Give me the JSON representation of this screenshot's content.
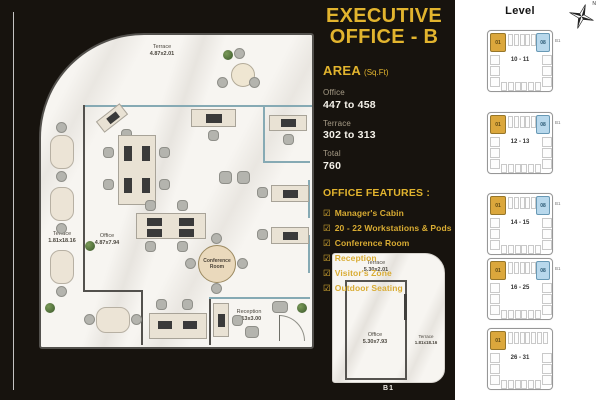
{
  "colors": {
    "gold": "#E2B42E",
    "background": "#17130E",
    "unit_gold": "#DBA73C",
    "unit_blue": "#B8D8EC"
  },
  "panel": {
    "title_line1": "EXECUTIVE",
    "title_line2": "OFFICE - B",
    "area_label": "AREA",
    "area_unit": "(Sq.Ft)",
    "metrics": [
      {
        "label": "Office",
        "value": "447 to 458"
      },
      {
        "label": "Terrace",
        "value": "302 to 313"
      },
      {
        "label": "Total",
        "value": "760"
      }
    ],
    "features_heading": "OFFICE FEATURES :",
    "checkbox_glyph": "☑",
    "features": [
      "Manager's Cabin",
      "20 - 22 Workstations & Pods",
      "Conference Room",
      "Reception",
      "Visitor's Zone",
      "Outdoor Seating"
    ]
  },
  "floorplan": {
    "terrace_top": {
      "name": "Terrace",
      "dim": "4.87x2.01"
    },
    "terrace_left": {
      "name": "Terrace",
      "dim": "1.81x18.16"
    },
    "office": {
      "name": "Office",
      "dim": "4.87x7.94"
    },
    "conference_room": "Conference Room",
    "reception": {
      "name": "Reception",
      "dim": "2.13x3.00"
    }
  },
  "miniplan": {
    "terrace_top": {
      "name": "Terrace",
      "dim": "5.30x2.01"
    },
    "office": {
      "name": "Office",
      "dim": "5.30x7.93"
    },
    "terrace_right": {
      "name": "Terrace",
      "dim": "1.81x18.16"
    },
    "unit_label": "B1"
  },
  "levels": {
    "heading": "Level",
    "compass_label": "N",
    "items": [
      {
        "label": "10 - 11",
        "gold_unit": "01",
        "blue_unit": "08",
        "side_label": "B1",
        "has_blue": true
      },
      {
        "label": "12 - 13",
        "gold_unit": "01",
        "blue_unit": "08",
        "side_label": "B1",
        "has_blue": true
      },
      {
        "label": "14 - 15",
        "gold_unit": "01",
        "blue_unit": "08",
        "side_label": "B1",
        "has_blue": true
      },
      {
        "label": "16 - 25",
        "gold_unit": "01",
        "blue_unit": "08",
        "side_label": "B1",
        "has_blue": true
      },
      {
        "label": "26 - 31",
        "gold_unit": "01",
        "blue_unit": "",
        "side_label": "",
        "has_blue": false
      }
    ]
  }
}
